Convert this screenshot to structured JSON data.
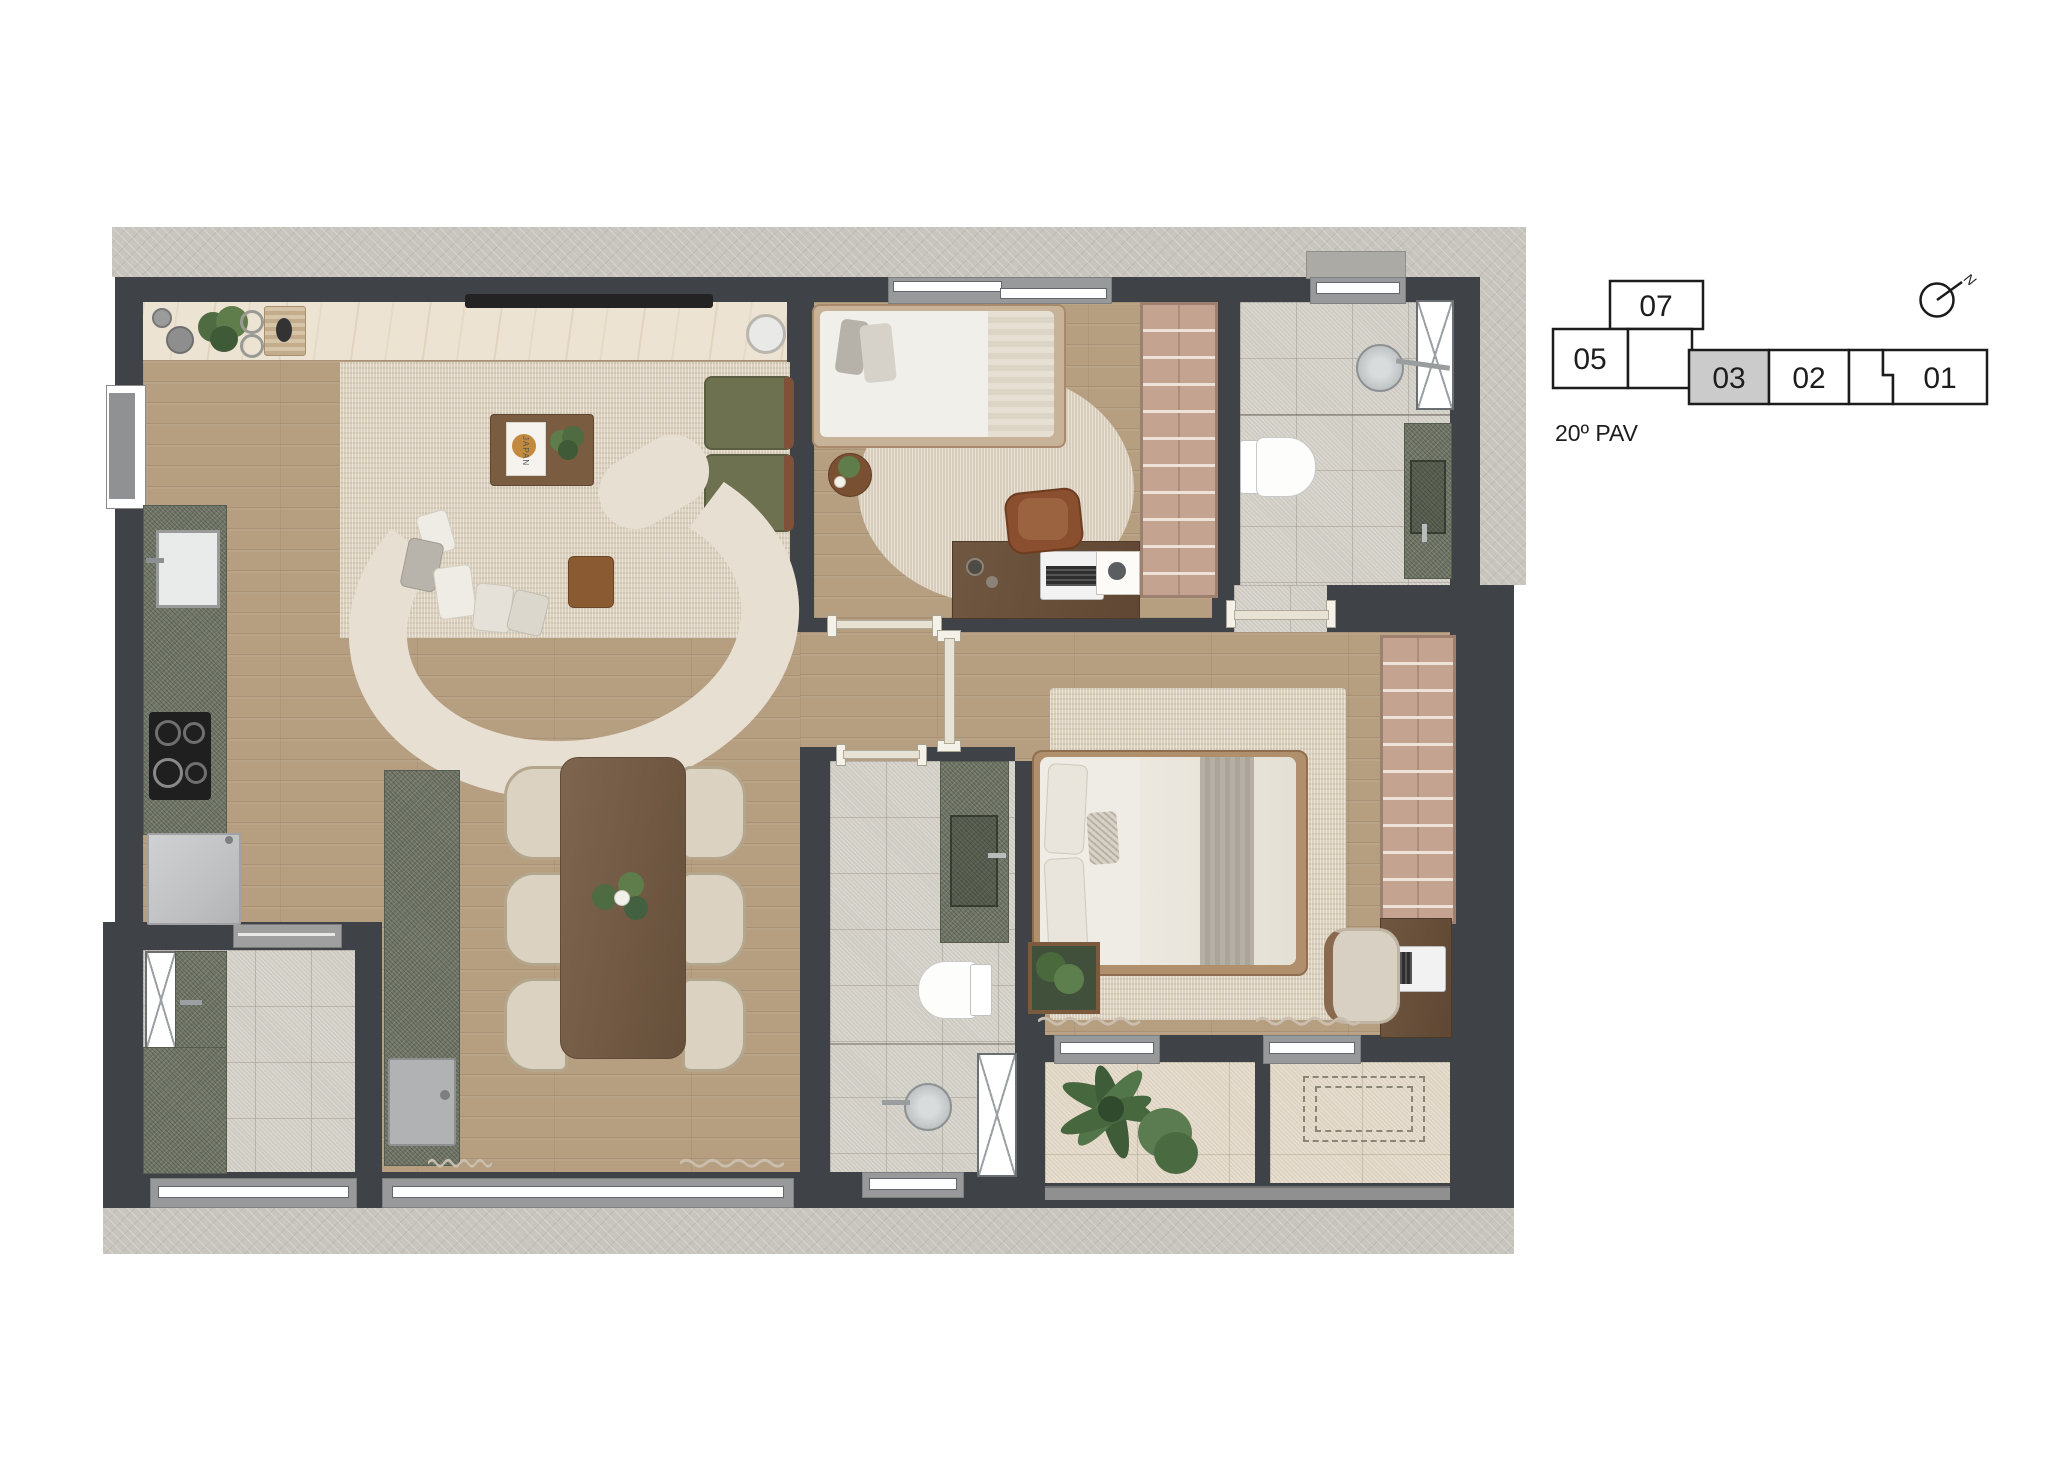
{
  "key_plan": {
    "floor_label": "20º PAV",
    "north_label": "N",
    "selected_unit": "03",
    "units": [
      {
        "label": "07",
        "selected": false
      },
      {
        "label": "05",
        "selected": false
      },
      {
        "label": "03",
        "selected": true
      },
      {
        "label": "02",
        "selected": false
      },
      {
        "label": "01",
        "selected": false
      }
    ]
  },
  "living_room": {
    "coffee_table_book_title": "JAPAN"
  },
  "palette": {
    "wall": "#3f4347",
    "concrete": "#c7c5be",
    "wood_floor": "#b69e81",
    "area_rug": "#dbd1be",
    "marble_counter": "#ece3d3",
    "green_stone": "#727868",
    "bathroom_tile": "#cecbc2",
    "balcony_tile": "#ded3c0",
    "wardrobe": "#c4a491",
    "walnut_furniture": "#77604b",
    "keyplan_selected_fill": "#cbcbcb"
  }
}
